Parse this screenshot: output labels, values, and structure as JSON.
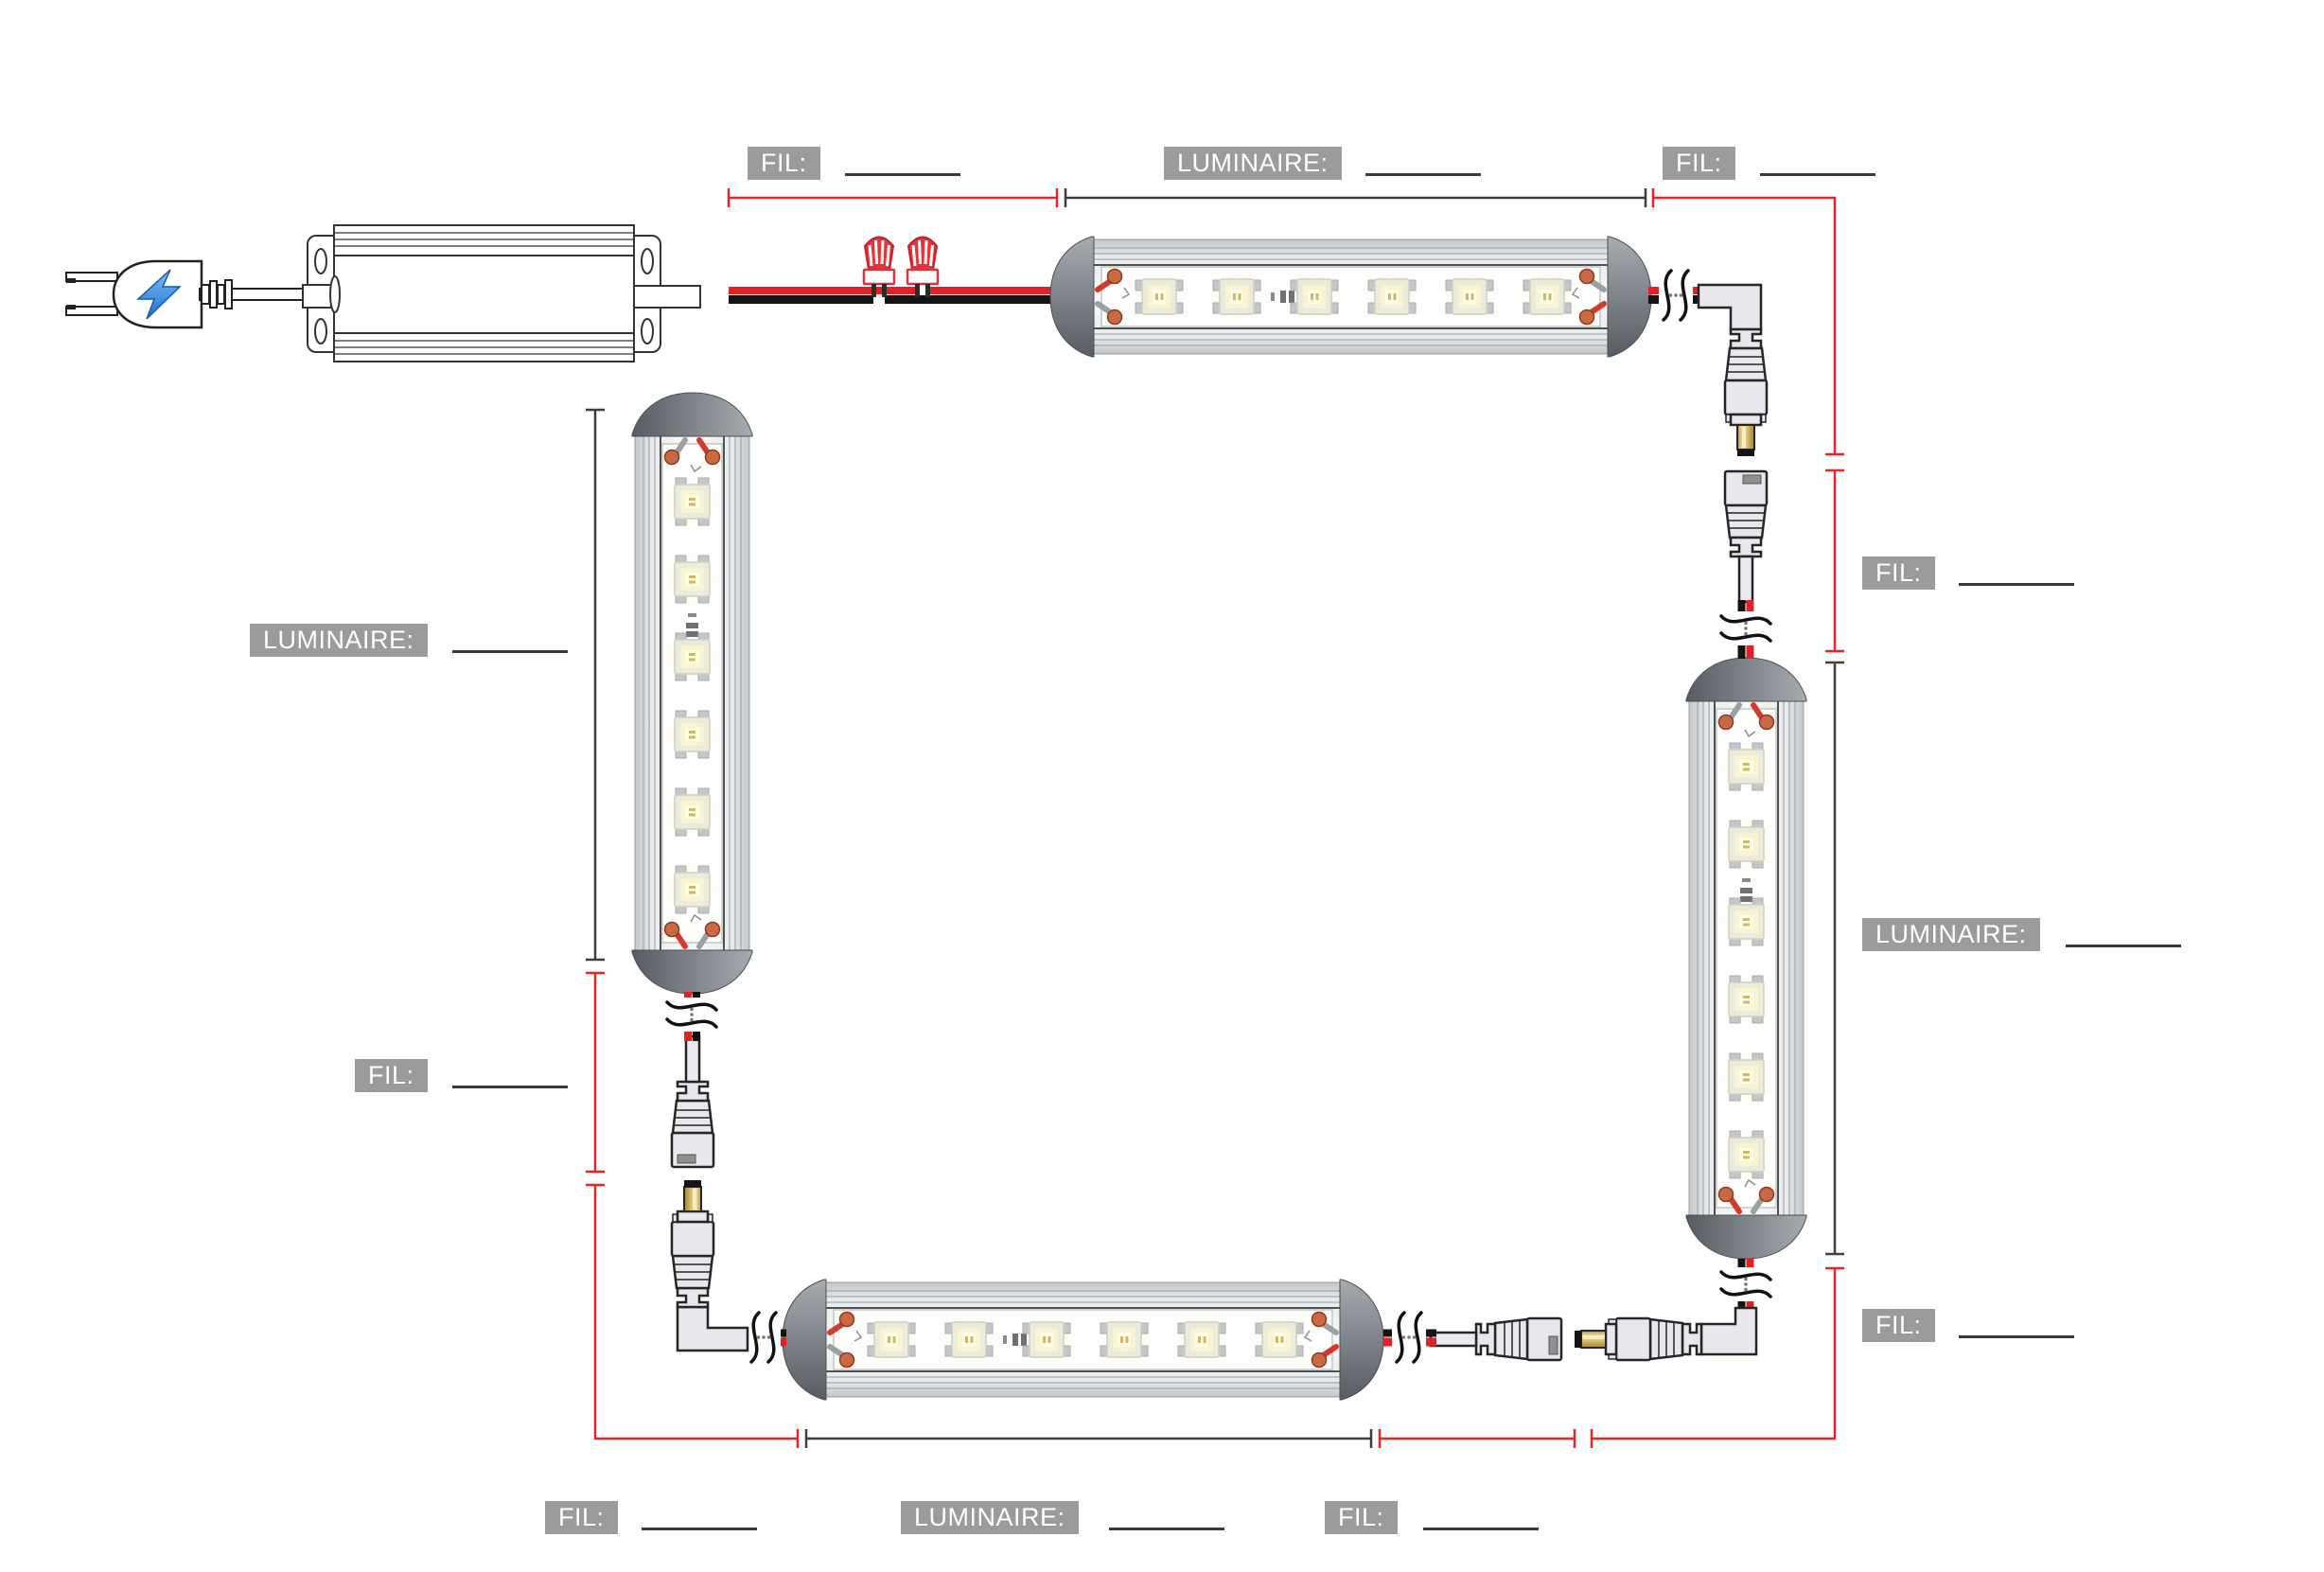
{
  "diagram_type": "led-luminaire-wiring-diagram",
  "language": "fr",
  "labels": [
    {
      "id": "fil-top-left",
      "text": "FIL:",
      "value": ""
    },
    {
      "id": "luminaire-top",
      "text": "LUMINAIRE:",
      "value": ""
    },
    {
      "id": "fil-top-right",
      "text": "FIL:",
      "value": ""
    },
    {
      "id": "fil-right-middle",
      "text": "FIL:",
      "value": ""
    },
    {
      "id": "luminaire-right",
      "text": "LUMINAIRE:",
      "value": ""
    },
    {
      "id": "fil-right-bottom",
      "text": "FIL:",
      "value": ""
    },
    {
      "id": "luminaire-left",
      "text": "LUMINAIRE:",
      "value": ""
    },
    {
      "id": "fil-left-middle",
      "text": "FIL:",
      "value": ""
    },
    {
      "id": "fil-bottom-left",
      "text": "FIL:",
      "value": ""
    },
    {
      "id": "luminaire-bottom",
      "text": "LUMINAIRE:",
      "value": ""
    },
    {
      "id": "fil-bottom-middle",
      "text": "FIL:",
      "value": ""
    }
  ],
  "components": {
    "power_plug_icon": "lightning-bolt-icon",
    "driver": "led-power-driver",
    "wire_nut_count": 2,
    "led_fixture_count": 4,
    "leds_per_fixture": 6,
    "dc_connector_pairs": 3
  },
  "colors": {
    "dimension_wire_red": "#ed2224",
    "dimension_luminaire_dark": "#3f3f3f",
    "wire_red": "#e02126",
    "wire_black": "#141414",
    "label_background": "#9b9b9b",
    "label_text": "#ffffff",
    "wire_nut_red": "#e8333c",
    "barrel_brass": "#d8c077",
    "lightning_blue": "#2f86dd",
    "background": "#ffffff"
  }
}
